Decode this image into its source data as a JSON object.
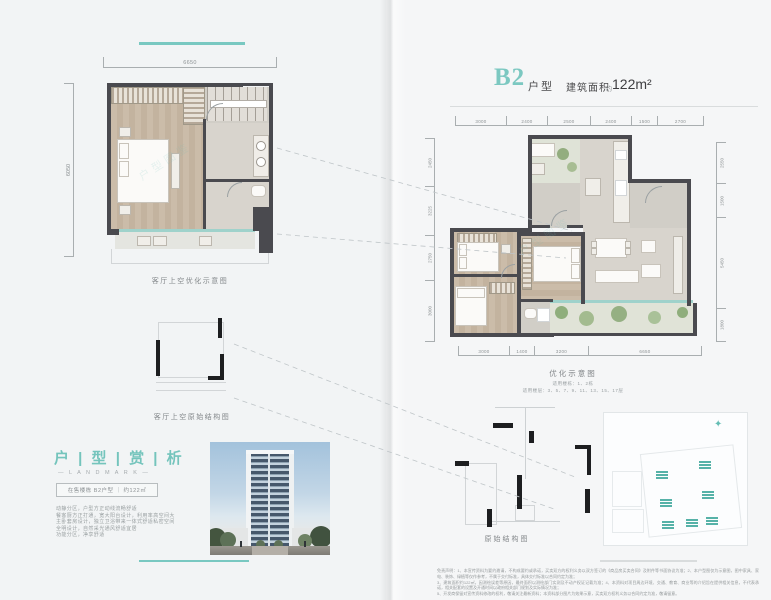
{
  "accent": "#7cc8c1",
  "left_page": {
    "top_rule": "",
    "detail_plan": {
      "dim_top": "6650",
      "dim_left": "6050",
      "caption": "客厅上空优化示意图",
      "watermark": "户型图鉴"
    },
    "outline_plan": {
      "caption": "客厅上空原始结构图"
    },
    "analysis": {
      "title": "户 | 型 | 赏 | 析",
      "subtitle": "— L A N D M A R K —",
      "tag": "在售楼栋 B2户型 ｜ 约122㎡",
      "lines": [
        "动静分区，户型方正动线流畅舒适",
        "餐客厨方正打通，宽大阳台设计，利用率高空间大",
        "主卧套房设计，独立卫浴带来一体式舒适私密空间",
        "全明设计，自然采光通风舒适宜居",
        "功能分区，净享舒适"
      ]
    }
  },
  "right_page": {
    "header": {
      "code": "B2",
      "type_label": "户型",
      "area_label": "建筑面积",
      "approx": "约",
      "area_value": "122m²"
    },
    "main_plan": {
      "caption": "优化示意图",
      "note1": "适用楼栋：1、2栋",
      "note2": "适用楼层：3、5、7、9、11、13、15、17层",
      "dims_top": [
        "3000",
        "2400",
        "2500",
        "2400",
        "1500",
        "2700"
      ],
      "dims_bottom": [
        "3000",
        "1400",
        "3200",
        "6650"
      ],
      "dims_left": [
        "2450",
        "3225",
        "2750",
        "3000"
      ],
      "dims_right": [
        "2550",
        "1500",
        "5450",
        "1800"
      ],
      "watermark": "户型图鉴"
    },
    "outline_plan": {
      "caption": "原始结构图"
    },
    "site_plan": {
      "compass_icon": "✦"
    },
    "disclaimer": [
      "免责声明：1、本宣传资料为要约邀请，不构成要约或承诺，买卖双方的权利义务以双方签订的《商品房买卖合同》及附件等书面协议为准；2、本户型图仅为示意图，图中家具、家电、装饰、绿植等仅作参考，不属于交付标准，具体交付标准以合同约定为准；",
      "3、建筑面积约122㎡，因测绘误差等原因，最终面积以测绘部门实测及不动产权证记载为准；4、本资料对项目周边环境、交通、教育、商业等的介绍旨在提供相关信息，不代表承诺，相关配套的设置及开通时间以政府相关部门规划及实际情况为准；",
      "5、开发商保留对宣传资料修改的权利，敬请关注最新资料；本资料部分图片为效果示意，买卖双方权利义务以合同约定为准，敬请留意。"
    ]
  }
}
